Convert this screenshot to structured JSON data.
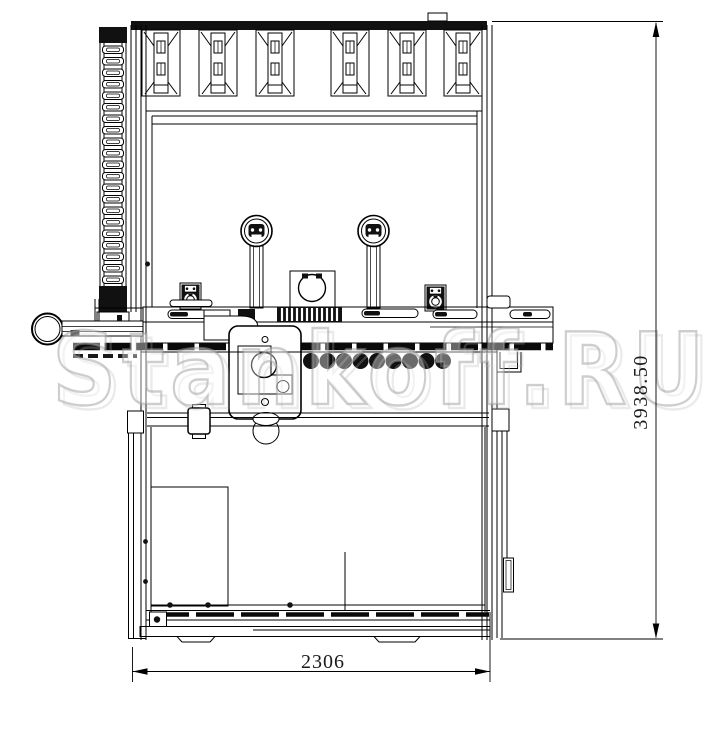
{
  "page": {
    "background": "#ffffff"
  },
  "drawing": {
    "name": "machine-front-elevation",
    "description": "Black-and-white CAD front view of an industrial woodworking machine with dimension callouts",
    "line_color": "#000000"
  },
  "dimensions": {
    "width_label": "2306",
    "height_label": "3938.50"
  },
  "watermark": {
    "text": "Stankoff.RU",
    "color": "#a8a8a8"
  }
}
